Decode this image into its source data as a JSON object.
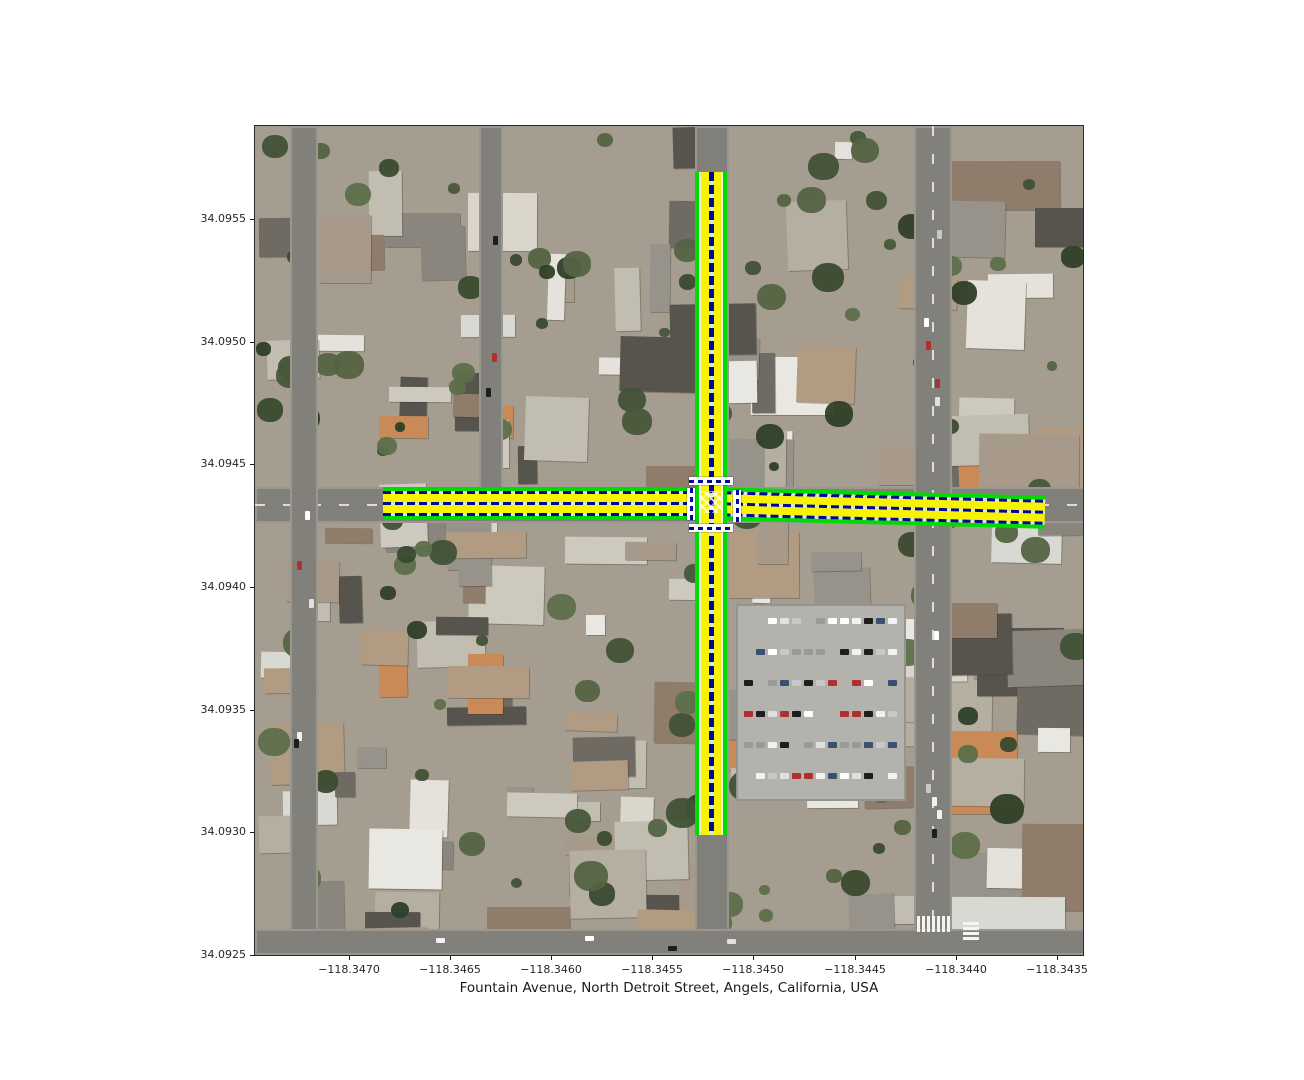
{
  "figure": {
    "width": 1304,
    "height": 1080,
    "background": "#ffffff",
    "xlabel": "Fountain Avenue, North Detroit Street, Angels, California, USA"
  },
  "axes": {
    "plot_area": {
      "left": 254,
      "top": 125,
      "width": 830,
      "height": 831
    },
    "x_ticks": [
      {
        "label": "−118.3470",
        "x": 349
      },
      {
        "label": "−118.3465",
        "x": 450
      },
      {
        "label": "−118.3460",
        "x": 551
      },
      {
        "label": "−118.3455",
        "x": 652
      },
      {
        "label": "−118.3450",
        "x": 753
      },
      {
        "label": "−118.3445",
        "x": 855
      },
      {
        "label": "−118.3440",
        "x": 956
      },
      {
        "label": "−118.3435",
        "x": 1057
      }
    ],
    "y_ticks": [
      {
        "label": "34.0955",
        "y": 219
      },
      {
        "label": "34.0950",
        "y": 342
      },
      {
        "label": "34.0945",
        "y": 464
      },
      {
        "label": "34.0940",
        "y": 587
      },
      {
        "label": "34.0935",
        "y": 710
      },
      {
        "label": "34.0930",
        "y": 832
      },
      {
        "label": "34.0925",
        "y": 955
      }
    ]
  },
  "map": {
    "seed": 20250412,
    "building_count": 150,
    "tree_count": 125,
    "palette": {
      "ground": "#a59e90",
      "street": "#82807a",
      "street_line": "#dedcd4",
      "parking": "#b4b2ac",
      "building_colors": [
        "#e4e2da",
        "#dad6cc",
        "#cdc9bf",
        "#c2bdb1",
        "#b5afa2",
        "#98938a",
        "#8b867d",
        "#a89a8a",
        "#b29b83",
        "#8f7c6a",
        "#6f6b63",
        "#57544e",
        "#c98a58",
        "#d9d9d3",
        "#e8e7e1"
      ],
      "tree_colors": [
        "#47573a",
        "#3a4a2f",
        "#546443",
        "#2f3f27",
        "#5d6f4a",
        "#415236"
      ],
      "car_colors": [
        "#f2f2f2",
        "#e0e0e0",
        "#1d1d1d",
        "#9a9a9a",
        "#b03030",
        "#3a4f72",
        "#c8c8c8",
        "#ffffff"
      ]
    },
    "streets": [
      {
        "name": "fountain-avenue-street",
        "dir": "h",
        "x": 0,
        "y": 361,
        "w": 830,
        "h": 36,
        "dashed": true,
        "cars": 6
      },
      {
        "name": "detroit-street",
        "dir": "v",
        "x": 440,
        "y": 0,
        "w": 34,
        "h": 831,
        "dashed": false,
        "cars": 4
      },
      {
        "name": "la-brea-avenue-street",
        "dir": "v",
        "x": 659,
        "y": 0,
        "w": 38,
        "h": 831,
        "dashed": true,
        "cars": 11
      },
      {
        "name": "west-residential-street",
        "dir": "v",
        "x": 35,
        "y": 0,
        "w": 28,
        "h": 831,
        "dashed": false,
        "cars": 5
      },
      {
        "name": "formosa-avenue-street",
        "dir": "v",
        "x": 224,
        "y": 0,
        "w": 24,
        "h": 365,
        "dashed": false,
        "cars": 3
      },
      {
        "name": "south-street",
        "dir": "h",
        "x": 0,
        "y": 803,
        "w": 830,
        "h": 26,
        "dashed": false,
        "cars": 4
      }
    ],
    "parking_lot": {
      "x": 481,
      "y": 478,
      "w": 170,
      "h": 197,
      "rows": 6,
      "row_start_y": 492,
      "row_step": 31,
      "cars_per_row": 13,
      "car_start_x": 489,
      "car_step": 12
    },
    "crosswalk_stripe_groups": [
      {
        "x": 662,
        "y": 790,
        "count": 7,
        "step": 5,
        "stripe_w": 3,
        "stripe_h": 16,
        "axis": "x"
      },
      {
        "x": 708,
        "y": 796,
        "count": 4,
        "step": 5,
        "stripe_w": 16,
        "stripe_h": 3,
        "axis": "y"
      }
    ]
  },
  "overlay": {
    "colors": {
      "edge": "#00dc00",
      "lane": "#f8f303",
      "divider": "#000a98",
      "divider_gap": "#e2e2d0",
      "white_sliver": "#f2f2e0",
      "crosswalk": "#ffffff"
    },
    "vertical_road": {
      "x": 441,
      "y": 47,
      "w": 32,
      "h": 663
    },
    "horizontal_west": {
      "x": 129,
      "y": 362,
      "w": 329,
      "h": 33
    },
    "horizontal_east": {
      "x": 457,
      "y": 362,
      "w": 334,
      "h": 33,
      "rotate": 1.5
    },
    "crosswalks": [
      {
        "name": "crosswalk-north",
        "x": 435,
        "y": 352,
        "w": 44,
        "h": 8,
        "dir": "h"
      },
      {
        "name": "crosswalk-south",
        "x": 435,
        "y": 399,
        "w": 44,
        "h": 8,
        "dir": "h"
      },
      {
        "name": "crosswalk-west",
        "x": 433,
        "y": 363,
        "w": 8,
        "h": 32,
        "dir": "v"
      },
      {
        "name": "crosswalk-east",
        "x": 479,
        "y": 365,
        "w": 8,
        "h": 32,
        "dir": "v"
      }
    ],
    "junction_box": {
      "x": 445,
      "y": 366,
      "w": 24,
      "h": 22
    }
  }
}
